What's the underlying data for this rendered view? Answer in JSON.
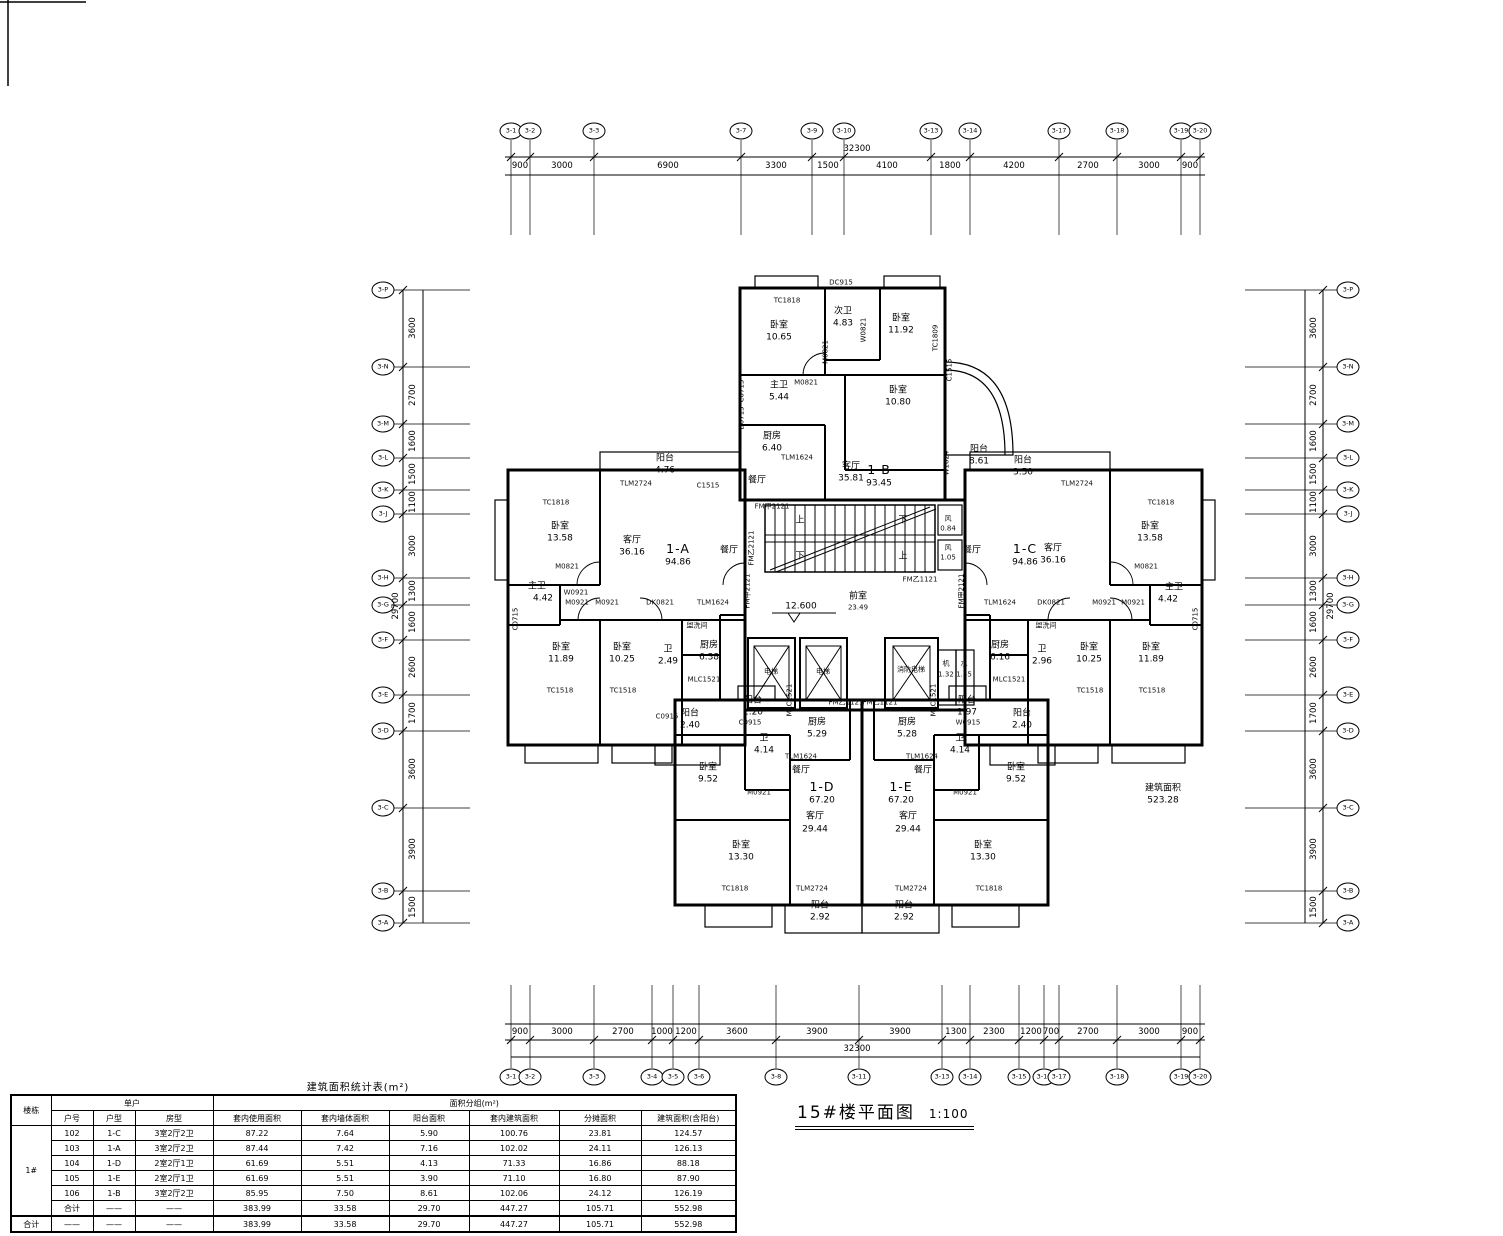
{
  "title": {
    "text": "15#楼平面图",
    "scale": "1:100"
  },
  "stats_table": {
    "caption": "建筑面积统计表(m²)",
    "col_building": "楼栋",
    "col_group_unit": "单户",
    "col_group_area": "面积分组(m²)",
    "sub_headers": [
      "户号",
      "户型",
      "房型",
      "套内使用面积",
      "套内墙体面积",
      "阳台面积",
      "套内建筑面积",
      "分摊面积",
      "建筑面积(含阳台)"
    ],
    "building_label": "1#",
    "rows": [
      [
        "102",
        "1-C",
        "3室2厅2卫",
        "87.22",
        "7.64",
        "5.90",
        "100.76",
        "23.81",
        "124.57"
      ],
      [
        "103",
        "1-A",
        "3室2厅2卫",
        "87.44",
        "7.42",
        "7.16",
        "102.02",
        "24.11",
        "126.13"
      ],
      [
        "104",
        "1-D",
        "2室2厅1卫",
        "61.69",
        "5.51",
        "4.13",
        "71.33",
        "16.86",
        "88.18"
      ],
      [
        "105",
        "1-E",
        "2室2厅1卫",
        "61.69",
        "5.51",
        "3.90",
        "71.10",
        "16.80",
        "87.90"
      ],
      [
        "106",
        "1-B",
        "3室2厅2卫",
        "85.95",
        "7.50",
        "8.61",
        "102.06",
        "24.12",
        "126.19"
      ],
      [
        "合计",
        "——",
        "——",
        "383.99",
        "33.58",
        "29.70",
        "447.27",
        "105.71",
        "552.98"
      ]
    ],
    "grand_total": [
      "合计",
      "——",
      "——",
      "——",
      "383.99",
      "33.58",
      "29.70",
      "447.27",
      "105.71",
      "552.98"
    ]
  },
  "grids": {
    "top": {
      "total": "32300",
      "bubbles": [
        [
          "3-1",
          511
        ],
        [
          "3-2",
          530
        ],
        [
          "3-3",
          594
        ],
        [
          "3-7",
          741
        ],
        [
          "3-9",
          812
        ],
        [
          "3-10",
          844
        ],
        [
          "3-13",
          931
        ],
        [
          "3-14",
          970
        ],
        [
          "3-17",
          1059
        ],
        [
          "3-18",
          1117
        ],
        [
          "3-19",
          1181
        ],
        [
          "3-20",
          1200
        ]
      ],
      "dims": [
        [
          "900",
          520
        ],
        [
          "3000",
          562
        ],
        [
          "6900",
          668
        ],
        [
          "3300",
          776
        ],
        [
          "1500",
          828
        ],
        [
          "4100",
          887
        ],
        [
          "1800",
          950
        ],
        [
          "4200",
          1014
        ],
        [
          "2700",
          1088
        ],
        [
          "3000",
          1149
        ],
        [
          "900",
          1190
        ]
      ]
    },
    "bottom": {
      "total": "32300",
      "bubbles": [
        [
          "3-1",
          511
        ],
        [
          "3-2",
          530
        ],
        [
          "3-3",
          594
        ],
        [
          "3-4",
          652
        ],
        [
          "3-5",
          673
        ],
        [
          "3-6",
          699
        ],
        [
          "3-8",
          776
        ],
        [
          "3-11",
          859
        ],
        [
          "3-13",
          942
        ],
        [
          "3-14",
          970
        ],
        [
          "3-15",
          1019
        ],
        [
          "3-16",
          1044
        ],
        [
          "3-17",
          1059
        ],
        [
          "3-18",
          1117
        ],
        [
          "3-19",
          1181
        ],
        [
          "3-20",
          1200
        ]
      ],
      "dims": [
        [
          "900",
          520
        ],
        [
          "3000",
          562
        ],
        [
          "2700",
          623
        ],
        [
          "1000",
          662
        ],
        [
          "1200",
          686
        ],
        [
          "3600",
          737
        ],
        [
          "3900",
          817
        ],
        [
          "3900",
          900
        ],
        [
          "1300",
          956
        ],
        [
          "2300",
          994
        ],
        [
          "1200",
          1031
        ],
        [
          "700",
          1051
        ],
        [
          "2700",
          1088
        ],
        [
          "3000",
          1149
        ],
        [
          "900",
          1190
        ]
      ]
    },
    "left": {
      "total": "29700",
      "bubbles": [
        [
          "3-P",
          290
        ],
        [
          "3-N",
          367
        ],
        [
          "3-M",
          424
        ],
        [
          "3-L",
          458
        ],
        [
          "3-K",
          490
        ],
        [
          "3-J",
          514
        ],
        [
          "3-H",
          578
        ],
        [
          "3-G",
          605
        ],
        [
          "3-F",
          640
        ],
        [
          "3-E",
          695
        ],
        [
          "3-D",
          731
        ],
        [
          "3-C",
          808
        ],
        [
          "3-B",
          891
        ],
        [
          "3-A",
          923
        ]
      ],
      "dims": [
        [
          "3600",
          328
        ],
        [
          "2700",
          395
        ],
        [
          "1600",
          441
        ],
        [
          "1500",
          474
        ],
        [
          "1100",
          502
        ],
        [
          "3000",
          546
        ],
        [
          "1300",
          591
        ],
        [
          "1600",
          622
        ],
        [
          "2600",
          667
        ],
        [
          "1700",
          713
        ],
        [
          "3600",
          769
        ],
        [
          "3900",
          849
        ],
        [
          "1500",
          907
        ]
      ]
    },
    "right": {
      "total": "29700",
      "bubbles": [
        [
          "3-P",
          290
        ],
        [
          "3-N",
          367
        ],
        [
          "3-M",
          424
        ],
        [
          "3-L",
          458
        ],
        [
          "3-K",
          490
        ],
        [
          "3-J",
          514
        ],
        [
          "3-H",
          578
        ],
        [
          "3-G",
          605
        ],
        [
          "3-F",
          640
        ],
        [
          "3-E",
          695
        ],
        [
          "3-D",
          731
        ],
        [
          "3-C",
          808
        ],
        [
          "3-B",
          891
        ],
        [
          "3-A",
          923
        ]
      ],
      "dims": [
        [
          "3600",
          328
        ],
        [
          "2700",
          395
        ],
        [
          "1600",
          441
        ],
        [
          "1500",
          474
        ],
        [
          "1100",
          502
        ],
        [
          "3000",
          546
        ],
        [
          "1300",
          591
        ],
        [
          "1600",
          622
        ],
        [
          "2600",
          667
        ],
        [
          "1700",
          713
        ],
        [
          "3600",
          769
        ],
        [
          "3900",
          849
        ],
        [
          "1500",
          907
        ]
      ]
    }
  },
  "plan": {
    "units": [
      {
        "id": "1-A",
        "area": "94.86"
      },
      {
        "id": "1-B",
        "area": "93.45"
      },
      {
        "id": "1-C",
        "area": "94.86"
      },
      {
        "id": "1-D",
        "area": "67.20"
      },
      {
        "id": "1-E",
        "area": "67.20"
      }
    ],
    "labels": [
      [
        "TC1818",
        787,
        301,
        "c"
      ],
      [
        "DC915",
        841,
        283,
        "c"
      ],
      [
        "卧室",
        779,
        326
      ],
      [
        "10.65",
        779,
        338
      ],
      [
        "次卫",
        843,
        312
      ],
      [
        "4.83",
        843,
        324
      ],
      [
        "W0821",
        864,
        330,
        "v"
      ],
      [
        "卧室",
        901,
        319
      ],
      [
        "11.92",
        901,
        331
      ],
      [
        "TC1809",
        936,
        338,
        "v"
      ],
      [
        "M0821",
        826,
        352,
        "v"
      ],
      [
        "M0821",
        806,
        383,
        "c"
      ],
      [
        "主卫",
        779,
        386
      ],
      [
        "5.44",
        779,
        398
      ],
      [
        "卧室",
        898,
        391
      ],
      [
        "10.80",
        898,
        403
      ],
      [
        "C1515",
        950,
        370,
        "v"
      ],
      [
        "C0715",
        742,
        391,
        "v"
      ],
      [
        "D0715",
        742,
        418,
        "v"
      ],
      [
        "厨房",
        772,
        437
      ],
      [
        "6.40",
        772,
        449
      ],
      [
        "TLM1624",
        797,
        458,
        "c"
      ],
      [
        "餐厅",
        757,
        481
      ],
      [
        "客厅",
        851,
        467
      ],
      [
        "35.81",
        851,
        479
      ],
      [
        "1-B",
        879,
        470,
        "u"
      ],
      [
        "93.45",
        879,
        484
      ],
      [
        "阳台",
        979,
        450
      ],
      [
        "8.61",
        979,
        462
      ],
      [
        "W1024",
        947,
        463,
        "v"
      ],
      [
        "阳台",
        665,
        459
      ],
      [
        "4.76",
        665,
        471
      ],
      [
        "TLM2724",
        636,
        484,
        "c"
      ],
      [
        "C1515",
        708,
        486,
        "c"
      ],
      [
        "TC1818",
        556,
        503,
        "c"
      ],
      [
        "卧室",
        560,
        527
      ],
      [
        "13.58",
        560,
        539
      ],
      [
        "客厅",
        632,
        541
      ],
      [
        "36.16",
        632,
        553
      ],
      [
        "1-A",
        678,
        549,
        "u"
      ],
      [
        "94.86",
        678,
        563
      ],
      [
        "餐厅",
        729,
        551
      ],
      [
        "M0821",
        567,
        567,
        "c"
      ],
      [
        "主卫",
        537,
        587
      ],
      [
        "4.42",
        543,
        599
      ],
      [
        "C0715",
        516,
        619,
        "v"
      ],
      [
        "W0921",
        576,
        593,
        "c"
      ],
      [
        "M0921",
        577,
        603,
        "c"
      ],
      [
        "M0921",
        607,
        603,
        "c"
      ],
      [
        "卧室",
        561,
        648
      ],
      [
        "11.89",
        561,
        660
      ],
      [
        "卧室",
        622,
        648
      ],
      [
        "10.25",
        622,
        660
      ],
      [
        "盥洗间",
        697,
        626,
        "c"
      ],
      [
        "DK0821",
        660,
        603,
        "c"
      ],
      [
        "TLM1624",
        713,
        603,
        "c"
      ],
      [
        "卫",
        668,
        650
      ],
      [
        "2.49",
        668,
        662
      ],
      [
        "厨房",
        709,
        646
      ],
      [
        "6.38",
        709,
        658
      ],
      [
        "MLC1521",
        704,
        680,
        "c"
      ],
      [
        "TC1518",
        560,
        691,
        "c"
      ],
      [
        "TC1518",
        623,
        691,
        "c"
      ],
      [
        "C0915",
        667,
        717,
        "c"
      ],
      [
        "阳台",
        690,
        714
      ],
      [
        "2.40",
        690,
        726
      ],
      [
        "FM甲2121",
        748,
        591,
        "v"
      ],
      [
        "阳台",
        1023,
        461
      ],
      [
        "3.50",
        1023,
        473
      ],
      [
        "TLM2724",
        1077,
        484,
        "c"
      ],
      [
        "TC1818",
        1161,
        503,
        "c"
      ],
      [
        "卧室",
        1150,
        527
      ],
      [
        "13.58",
        1150,
        539
      ],
      [
        "1-C",
        1025,
        549,
        "u"
      ],
      [
        "94.86",
        1025,
        563
      ],
      [
        "客厅",
        1053,
        549
      ],
      [
        "36.16",
        1053,
        561
      ],
      [
        "餐厅",
        972,
        551
      ],
      [
        "M0821",
        1146,
        567,
        "c"
      ],
      [
        "主卫",
        1174,
        588
      ],
      [
        "4.42",
        1168,
        600
      ],
      [
        "C0715",
        1196,
        619,
        "v"
      ],
      [
        "M0921",
        1104,
        603,
        "c"
      ],
      [
        "M0921",
        1133,
        603,
        "c"
      ],
      [
        "卧室",
        1089,
        648
      ],
      [
        "10.25",
        1089,
        660
      ],
      [
        "卧室",
        1151,
        648
      ],
      [
        "11.89",
        1151,
        660
      ],
      [
        "盥洗间",
        1046,
        626,
        "c"
      ],
      [
        "TLM1624",
        1000,
        603,
        "c"
      ],
      [
        "DK0821",
        1051,
        603,
        "c"
      ],
      [
        "卫",
        1042,
        650
      ],
      [
        "2.96",
        1042,
        662
      ],
      [
        "厨房",
        1000,
        646
      ],
      [
        "6.16",
        1000,
        658
      ],
      [
        "MLC1521",
        1009,
        680,
        "c"
      ],
      [
        "TC1518",
        1090,
        691,
        "c"
      ],
      [
        "TC1518",
        1152,
        691,
        "c"
      ],
      [
        "阳台",
        1022,
        714
      ],
      [
        "2.40",
        1022,
        726
      ],
      [
        "FM甲2121",
        962,
        591,
        "v"
      ],
      [
        "阳台",
        753,
        701
      ],
      [
        "1.20",
        753,
        713
      ],
      [
        "C0915",
        750,
        723,
        "c"
      ],
      [
        "MLC1521",
        790,
        700,
        "v"
      ],
      [
        "厨房",
        817,
        723
      ],
      [
        "5.29",
        817,
        735
      ],
      [
        "卫",
        764,
        739
      ],
      [
        "4.14",
        764,
        751
      ],
      [
        "TLM1624",
        801,
        757,
        "c"
      ],
      [
        "卧室",
        708,
        768
      ],
      [
        "9.52",
        708,
        780
      ],
      [
        "餐厅",
        801,
        771
      ],
      [
        "M0921",
        759,
        793,
        "c"
      ],
      [
        "1-D",
        822,
        787,
        "u"
      ],
      [
        "67.20",
        822,
        801
      ],
      [
        "客厅",
        815,
        817
      ],
      [
        "29.44",
        815,
        830
      ],
      [
        "卧室",
        741,
        846
      ],
      [
        "13.30",
        741,
        858
      ],
      [
        "TC1818",
        735,
        889,
        "c"
      ],
      [
        "TLM2724",
        812,
        889,
        "c"
      ],
      [
        "阳台",
        820,
        906
      ],
      [
        "2.92",
        820,
        918
      ],
      [
        "阳台",
        967,
        701
      ],
      [
        "1.97",
        967,
        713
      ],
      [
        "W0915",
        968,
        723,
        "c"
      ],
      [
        "MLC1521",
        934,
        700,
        "v"
      ],
      [
        "厨房",
        907,
        723
      ],
      [
        "5.28",
        907,
        735
      ],
      [
        "卫",
        960,
        739
      ],
      [
        "4.14",
        960,
        751
      ],
      [
        "TLM1624",
        922,
        757,
        "c"
      ],
      [
        "卧室",
        1016,
        768
      ],
      [
        "9.52",
        1016,
        780
      ],
      [
        "餐厅",
        923,
        771
      ],
      [
        "M0921",
        965,
        793,
        "c"
      ],
      [
        "1-E",
        901,
        787,
        "u"
      ],
      [
        "67.20",
        901,
        801
      ],
      [
        "客厅",
        908,
        817
      ],
      [
        "29.44",
        908,
        830
      ],
      [
        "卧室",
        983,
        846
      ],
      [
        "13.30",
        983,
        858
      ],
      [
        "TC1818",
        989,
        889,
        "c"
      ],
      [
        "TLM2724",
        911,
        889,
        "c"
      ],
      [
        "阳台",
        904,
        906
      ],
      [
        "2.92",
        904,
        918
      ],
      [
        "FM甲2121",
        772,
        507,
        "c"
      ],
      [
        "上",
        800,
        521
      ],
      [
        "下",
        903,
        521
      ],
      [
        "下",
        800,
        557
      ],
      [
        "上",
        903,
        557
      ],
      [
        "FM乙2121",
        752,
        548,
        "v"
      ],
      [
        "FM乙1121",
        920,
        580,
        "c"
      ],
      [
        "风",
        948,
        519,
        "c"
      ],
      [
        "0.84",
        948,
        529,
        "c"
      ],
      [
        "风",
        948,
        548,
        "c"
      ],
      [
        "1.05",
        948,
        558,
        "c"
      ],
      [
        "前室",
        858,
        597
      ],
      [
        "23.49",
        858,
        608,
        "c"
      ],
      [
        "12.600",
        801,
        607
      ],
      [
        "电梯",
        771,
        672,
        "c"
      ],
      [
        "电梯",
        823,
        672,
        "c"
      ],
      [
        "消防电梯",
        911,
        670,
        "c"
      ],
      [
        "机",
        946,
        664,
        "c"
      ],
      [
        "1.32",
        946,
        675,
        "c"
      ],
      [
        "水",
        964,
        664,
        "c"
      ],
      [
        "1.55",
        964,
        675,
        "c"
      ],
      [
        "FM乙1121",
        846,
        703,
        "c"
      ],
      [
        "FM乙1121",
        880,
        703,
        "c"
      ],
      [
        "建筑面积",
        1163,
        789
      ],
      [
        "523.28",
        1163,
        801
      ]
    ]
  }
}
